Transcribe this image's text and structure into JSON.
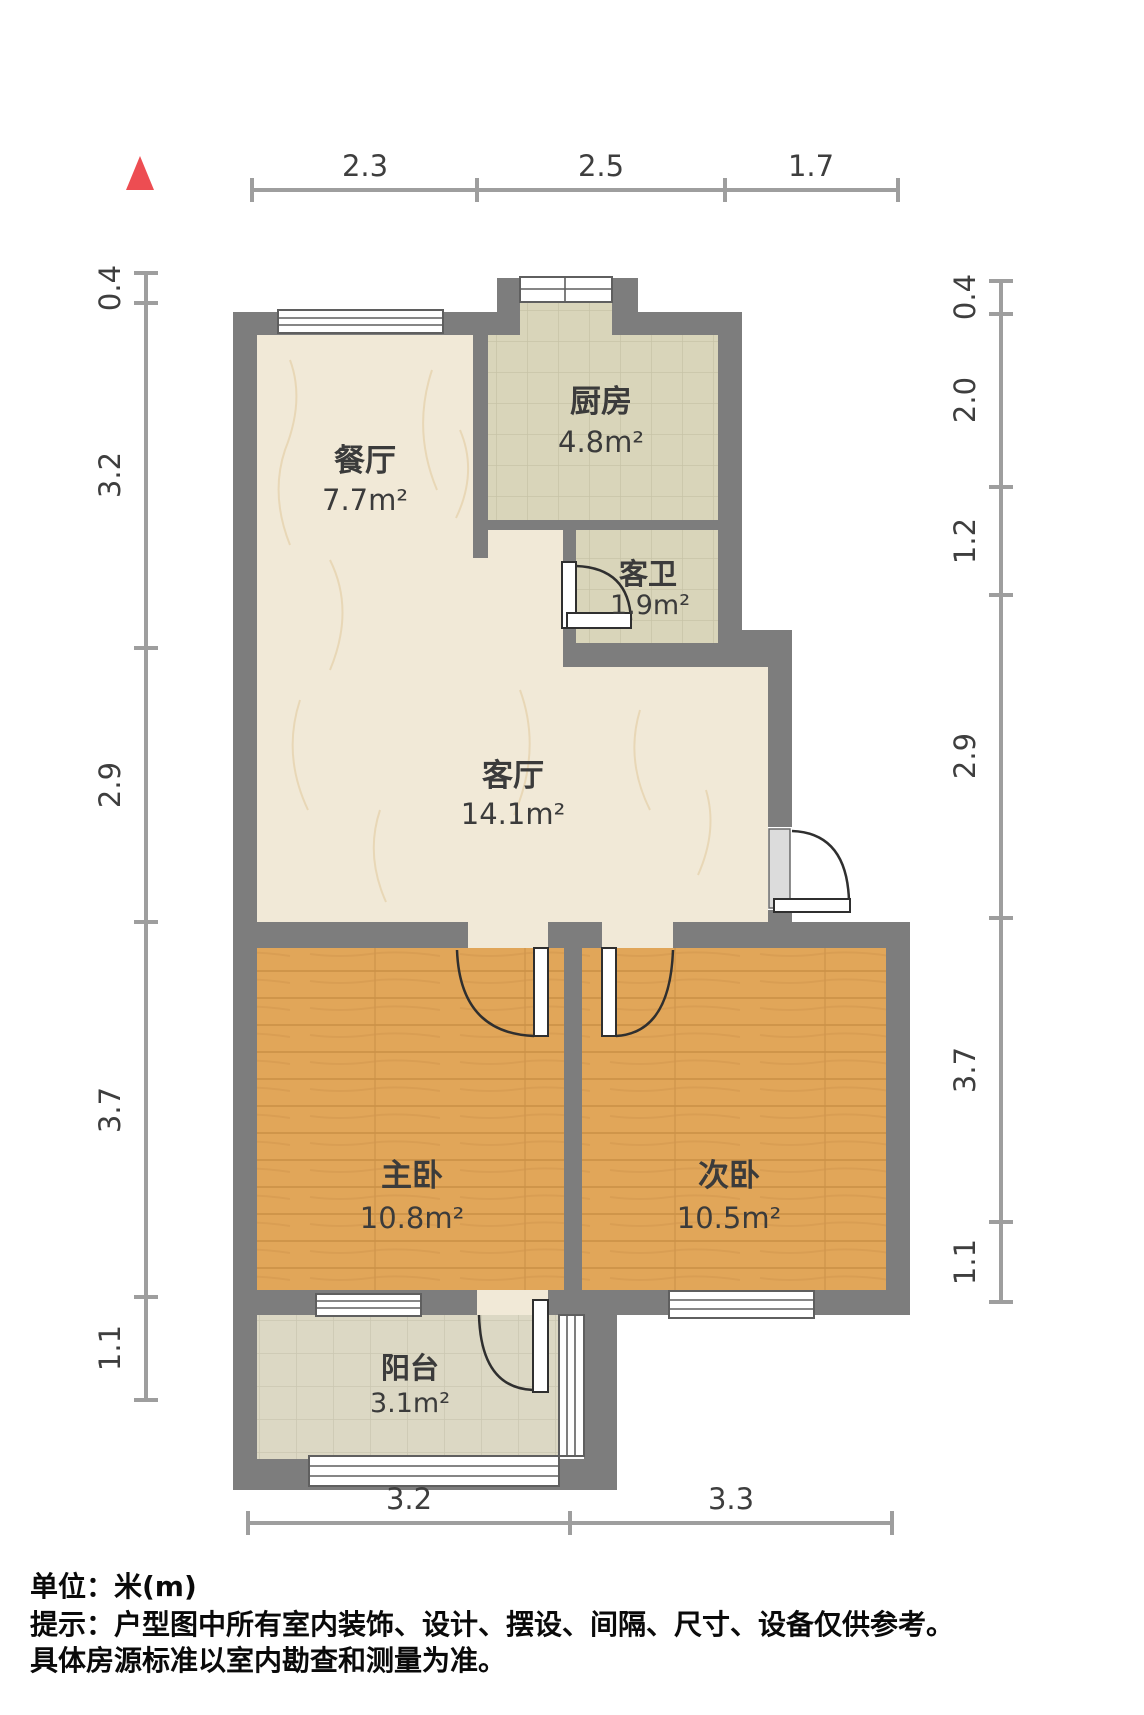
{
  "north_indicator": {
    "icon": "north-triangle",
    "color": "#ed4d52"
  },
  "dimensions": {
    "top": [
      "2.3",
      "2.5",
      "1.7"
    ],
    "left": [
      "0.4",
      "3.2",
      "2.9",
      "3.7",
      "1.1"
    ],
    "right": [
      "0.4",
      "2.0",
      "1.2",
      "2.9",
      "3.7",
      "1.1"
    ],
    "bottom": [
      "3.2",
      "3.3"
    ]
  },
  "rooms": {
    "dining": {
      "name": "餐厅",
      "area": "7.7m²"
    },
    "kitchen": {
      "name": "厨房",
      "area": "4.8m²"
    },
    "bath": {
      "name": "客卫",
      "area": "1.9m²"
    },
    "living": {
      "name": "客厅",
      "area": "14.1m²"
    },
    "master": {
      "name": "主卧",
      "area": "10.8m²"
    },
    "second": {
      "name": "次卧",
      "area": "10.5m²"
    },
    "balcony": {
      "name": "阳台",
      "area": "3.1m²"
    }
  },
  "footer": {
    "unit_line": "单位：米(m)",
    "note_line1": "提示：户型图中所有室内装饰、设计、摆设、间隔、尺寸、设备仅供参考。",
    "note_line2": "具体房源标准以室内勘查和测量为准。"
  },
  "colors": {
    "wall": "#7d7d7d",
    "marble_floor": "#f1e9d7",
    "tile_floor": "#d9d5ba",
    "wood_floor": "#e1a659",
    "balcony_floor": "#dcd8c4",
    "dim_line": "#9e9e9e",
    "label_text": "#3b3b3b",
    "north": "#ed4d52"
  }
}
